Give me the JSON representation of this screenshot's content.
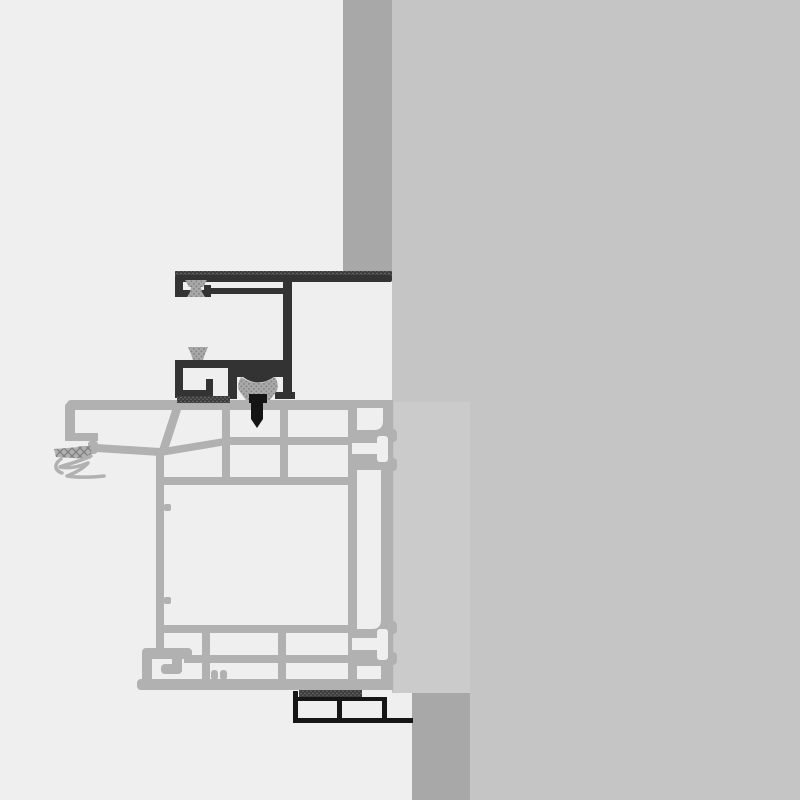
{
  "meta": {
    "title": "Window frame installation cross-section detail drawing",
    "type": "technical-section-drawing",
    "canvas": {
      "width": 800,
      "height": 800
    },
    "text_content": "none (drawing contains no visible text)"
  },
  "colors": {
    "background_left": "#efefef",
    "background_right": "#c5c5c5",
    "wall_masonry": "#a8a8a8",
    "infill_block": "#cbcbcb",
    "frame_profile": "#b1b1b1",
    "dark_profile": "#333333",
    "fastener_black": "#141414",
    "subframe_black": "#161616",
    "gasket_gray": "#a9a9a9",
    "gasket_dot": "#868686",
    "tape_dark": "#3c3c3c",
    "tape_dot": "#707070",
    "hatch_line": "#7f7f7f"
  },
  "parts": [
    "wall-masonry-strip",
    "wall-render-layer",
    "reveal-infill-block",
    "base-support-block",
    "cover-profile-dark",
    "mushroom-gasket-upper",
    "mushroom-gasket-lower",
    "clamp-gasket-block",
    "fixing-screw",
    "compression-tape-upper",
    "compression-tape-lower",
    "window-frame-profile",
    "frame-outer-gasket-hatched",
    "frame-gasket-lip",
    "fixing-lug-t-slot-upper",
    "fixing-lug-t-slot-lower",
    "subsill-extension-profile"
  ]
}
